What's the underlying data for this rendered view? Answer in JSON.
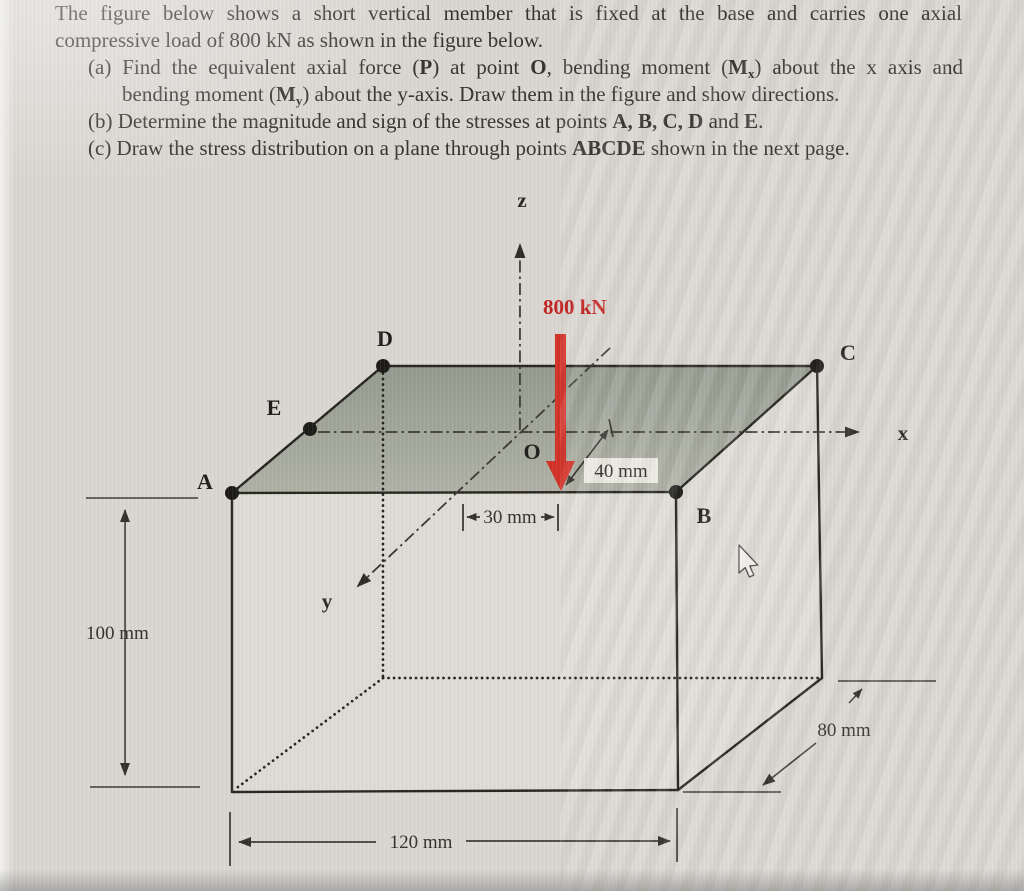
{
  "problem": {
    "lines": [
      {
        "segs": [
          {
            "t": "The figure below shows a short vertical member that is fixed at the base and carries one axial"
          }
        ]
      },
      {
        "segs": [
          {
            "t": "compressive load of 800 kN as shown in the figure below."
          }
        ]
      },
      {
        "segs": [
          {
            "t": "(a) Find the equivalent axial force ("
          },
          {
            "t": "P"
          },
          {
            "t": ") at point "
          },
          {
            "t": "O"
          },
          {
            "t": ", bending moment ("
          },
          {
            "t": "M"
          },
          {
            "t": "x"
          },
          {
            "t": ") about the x axis and"
          }
        ]
      },
      {
        "segs": [
          {
            "t": "bending moment ("
          },
          {
            "t": "M"
          },
          {
            "t": "y"
          },
          {
            "t": ") about the y-axis. Draw them in the figure and show directions."
          }
        ]
      },
      {
        "segs": [
          {
            "t": "(b) Determine the magnitude and sign of the stresses at points "
          },
          {
            "t": "A, B, C, D"
          },
          {
            "t": " and "
          },
          {
            "t": "E"
          },
          {
            "t": "."
          }
        ]
      },
      {
        "segs": [
          {
            "t": "(c) Draw the stress distribution on a plane through points "
          },
          {
            "t": "ABCDE"
          },
          {
            "t": " shown in the next page."
          }
        ]
      }
    ]
  },
  "figure": {
    "load_label": "800 kN",
    "axes": {
      "x": "x",
      "y": "y",
      "z": "z"
    },
    "points": {
      "A": "A",
      "B": "B",
      "C": "C",
      "D": "D",
      "E": "E",
      "O": "O"
    },
    "dimensions": {
      "height": "100 mm",
      "width": "120 mm",
      "depth": "80 mm",
      "offset_x": "30 mm",
      "offset_y": "40 mm"
    },
    "colors": {
      "load_arrow": "#d23128",
      "load_text": "#c32220",
      "top_face_back": "#949a8e",
      "top_face_front": "#afb1a5"
    }
  }
}
